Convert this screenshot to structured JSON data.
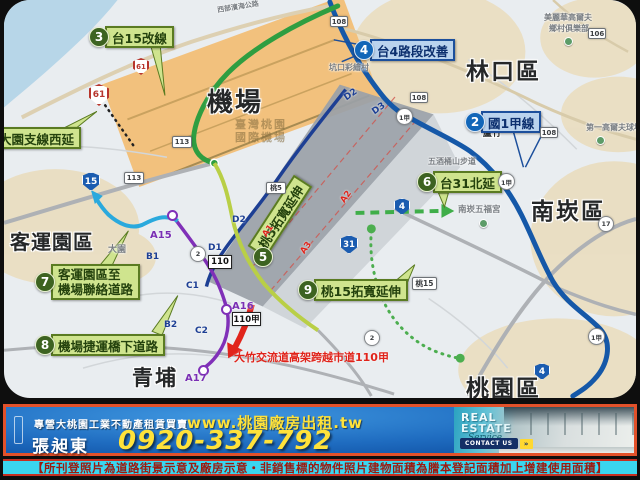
{
  "colors": {
    "project_green": "#3d6321",
    "project_blue": "#1266b8",
    "banner_blue": "#1f6cc0",
    "banner_yellow": "#ffe23a",
    "border_orange": "#e2512a",
    "disclaimer_cyan": "#3ad6ef",
    "red_annotation": "#e0231a",
    "airport_orange": "#f2c17d"
  },
  "map": {
    "regions": {
      "airport": "機場",
      "airport_sub1": "臺灣桃園",
      "airport_sub2": "國際機場",
      "linkou": "林口區",
      "nankan": "南崁區",
      "taoyuan": "桃園區",
      "qingpu": "青埔",
      "keyun": "客運園區",
      "luzhu": "蘆竹",
      "dayuan": "大園"
    },
    "projects": {
      "p1": {
        "label": "大園支線西延"
      },
      "p2": {
        "num": "2",
        "label": "國1甲線"
      },
      "p3": {
        "num": "3",
        "label": "台15改線"
      },
      "p4": {
        "num": "4",
        "label": "台4路段改善"
      },
      "p5": {
        "num": "5",
        "label": "桃5拓寬延伸"
      },
      "p6": {
        "num": "6",
        "label": "台31北延"
      },
      "p7": {
        "num": "7",
        "label1": "客運園區至",
        "label2": "機場聯絡道路"
      },
      "p8": {
        "num": "8",
        "label": "機場捷運橋下道路"
      },
      "p9": {
        "num": "9",
        "label": "桃15拓寬延伸"
      }
    },
    "red_note": "大竹交流道高架跨越市道110甲",
    "landmarks": {
      "coast_road": "西部濱海公路",
      "kengkou": "坑口彩繪村",
      "golf1a": "美麗華高爾夫",
      "golf1b": "鄉村俱樂部",
      "golf2": "第一高爾夫球場",
      "wujiu": "五酒桶山步道",
      "wufu": "南崁五福宮"
    },
    "stations": {
      "a15": "A15",
      "a16": "A16",
      "a17": "A17",
      "b1": "B1",
      "b2": "B2",
      "c1": "C1",
      "c2": "C2",
      "d1": "D1",
      "d2a": "D2",
      "d2b": "D2",
      "d3": "D3",
      "a1": "A1",
      "a2": "A2",
      "a3": "A3"
    },
    "shields": {
      "s61": "61",
      "s61b": "61",
      "s15": "15",
      "s113a": "113",
      "s113b": "113",
      "s110": "110",
      "s110j": "110甲",
      "s108a": "108",
      "s108b": "108",
      "s108c": "108",
      "s106": "106",
      "s1ja": "1甲",
      "s1jb": "1甲",
      "s1jc": "1甲",
      "s31": "31",
      "s4a": "4",
      "s4b": "4",
      "s2a": "2",
      "s2b": "2",
      "s17": "17",
      "st5": "桃5",
      "st15": "桃15"
    }
  },
  "banner": {
    "tagline": "專營大桃園工業不動產租賃買賣",
    "website": "www.桃園廠房出租.tw",
    "agent": "張昶東",
    "phone": "0920-337-792",
    "re1": "REAL",
    "re2": "ESTATE",
    "re3": "Service",
    "contact": "CONTACT US",
    "contact_go": "»"
  },
  "disclaimer": "【所刊登照片為道路街景示意及廠房示意‧非銷售標的物件照片建物面積為謄本登記面積加上增建使用面積】"
}
